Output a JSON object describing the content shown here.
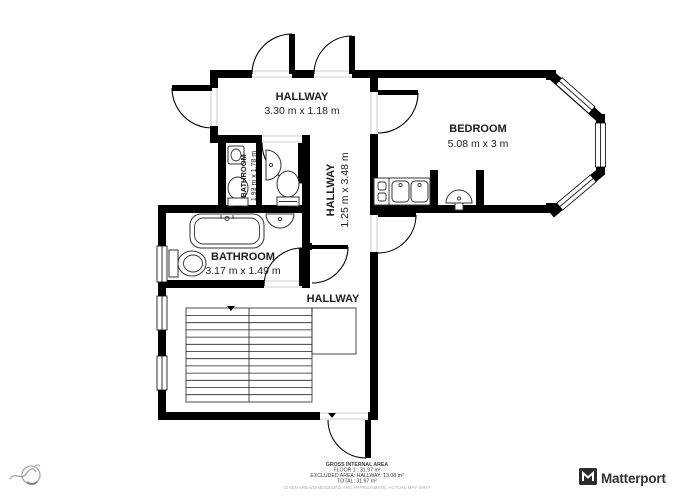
{
  "plan": {
    "rooms": [
      {
        "name": "HALLWAY",
        "dims": "3.30 m x 1.18 m"
      },
      {
        "name": "BEDROOM",
        "dims": "5.08 m x 3 m"
      },
      {
        "name": "BATHROOM",
        "dims": "1.93 m x 1.78 m"
      },
      {
        "name": "HALLWAY",
        "dims": "1.25 m x 3.48 m"
      },
      {
        "name": "BATHROOM",
        "dims": "3.17 m x 1.49 m"
      },
      {
        "name": "HALLWAY",
        "dims": ""
      }
    ]
  },
  "footer": {
    "area_summary": {
      "title": "GROSS INTERNAL AREA",
      "floor": "FLOOR 1 : 31.97 m²",
      "excluded": "EXCLUDED AREA: HALLWAY: 13.08 m²",
      "total": "TOTAL: 31.97 m²",
      "disclaimer": "GIVEN AREA/DIMENSIONS ARE APPROXIMATE, ACTUAL MAY VARY"
    },
    "brand": {
      "name": "Matterport"
    }
  },
  "icons": {
    "matterport_mark": "matterport-cube-icon",
    "agency_logo": "agency-logo"
  },
  "colors": {
    "wall": "#000000",
    "fixture_line": "#333333",
    "muted": "#ababab",
    "brand_text": "#333333"
  }
}
